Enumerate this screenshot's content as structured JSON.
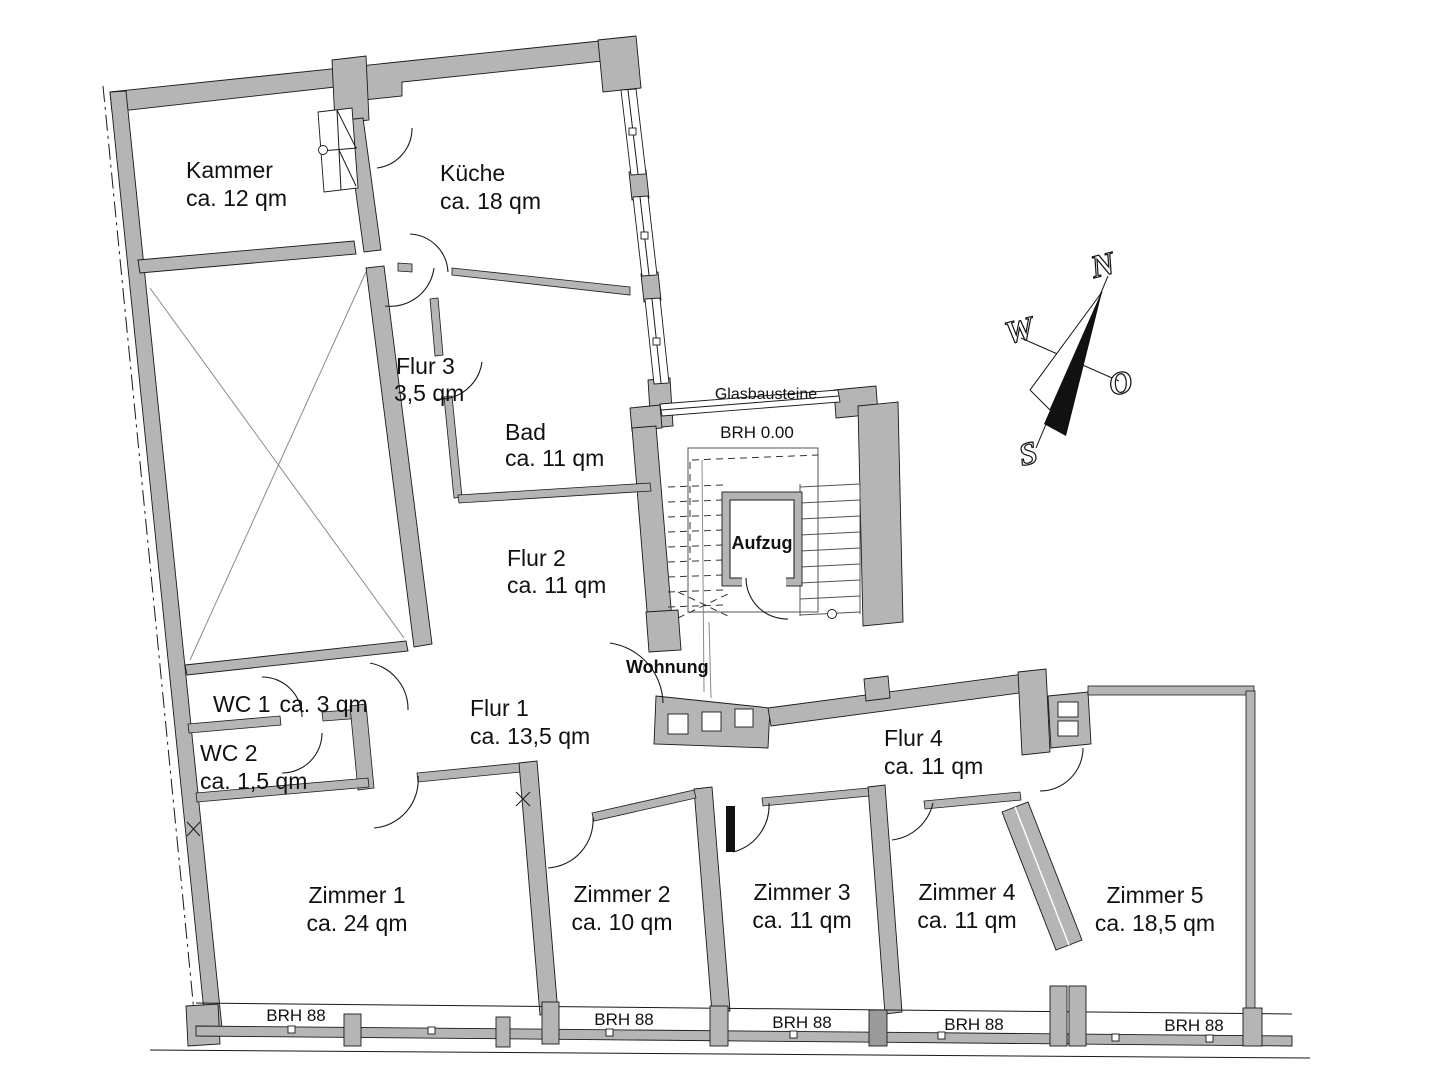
{
  "title": "Wohnungsgrundriss",
  "rooms": [
    {
      "id": "kammer",
      "name": "Kammer",
      "area": "ca. 12 qm"
    },
    {
      "id": "kueche",
      "name": "Küche",
      "area": "ca. 18 qm"
    },
    {
      "id": "flur3",
      "name": "Flur 3",
      "area": "3,5 qm"
    },
    {
      "id": "bad",
      "name": "Bad",
      "area": "ca. 11 qm"
    },
    {
      "id": "flur2",
      "name": "Flur 2",
      "area": "ca. 11 qm"
    },
    {
      "id": "wc1",
      "name": "WC 1",
      "area": "ca. 3 qm"
    },
    {
      "id": "wc2",
      "name": "WC 2",
      "area": "ca. 1,5 qm"
    },
    {
      "id": "flur1",
      "name": "Flur 1",
      "area": "ca. 13,5 qm"
    },
    {
      "id": "flur4",
      "name": "Flur 4",
      "area": "ca. 11 qm"
    },
    {
      "id": "zimmer1",
      "name": "Zimmer 1",
      "area": "ca. 24 qm"
    },
    {
      "id": "zimmer2",
      "name": "Zimmer 2",
      "area": "ca. 10 qm"
    },
    {
      "id": "zimmer3",
      "name": "Zimmer 3",
      "area": "ca. 11 qm"
    },
    {
      "id": "zimmer4",
      "name": "Zimmer 4",
      "area": "ca. 11 qm"
    },
    {
      "id": "zimmer5",
      "name": "Zimmer 5",
      "area": "ca. 18,5 qm"
    }
  ],
  "annotations": {
    "entrance": "Wohnung",
    "elevator": "Aufzug",
    "glass_blocks": "Glasbausteine",
    "sill_stairwell": "BRH 0.00",
    "sills": [
      "BRH 88",
      "BRH 88",
      "BRH 88",
      "BRH 88",
      "BRH 88"
    ]
  },
  "compass": {
    "north": "N",
    "west": "W",
    "east": "O",
    "south": "S"
  },
  "colors": {
    "wall": "#b5b5b5",
    "wall_dark": "#9a9a9a",
    "line": "#1a1a1a",
    "background": "#ffffff"
  }
}
